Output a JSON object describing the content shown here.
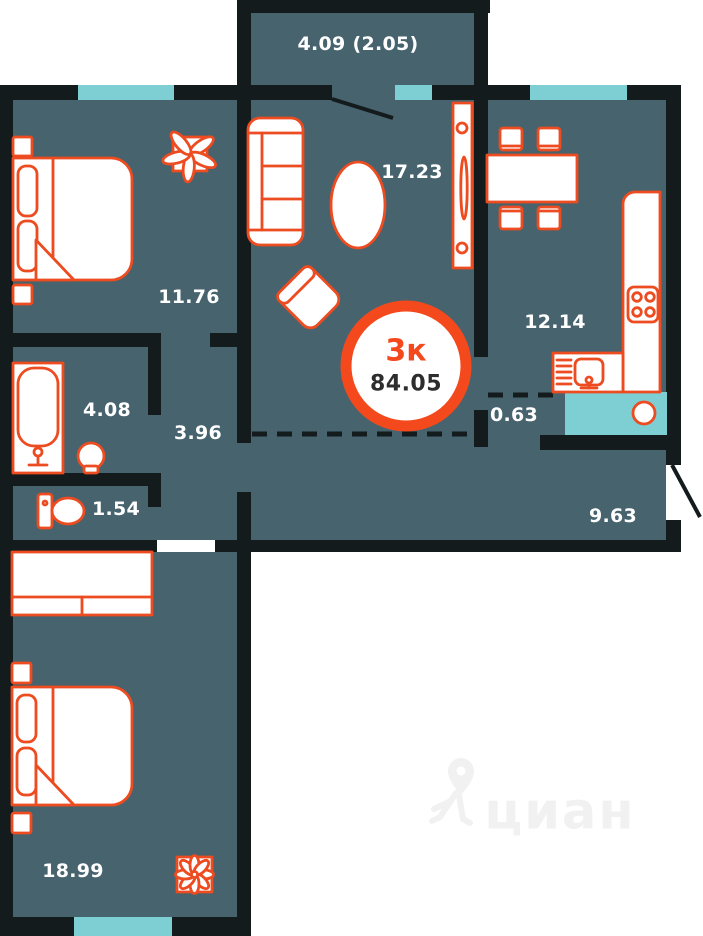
{
  "labels": {
    "balcony": "4.09 (2.05)",
    "living_room": "17.23",
    "bedroom_top": "11.76",
    "kitchen": "12.14",
    "bathroom": "4.08",
    "hallway": "3.96",
    "niche": "0.63",
    "toilet": "1.54",
    "corridor": "9.63",
    "bedroom_bottom": "18.99"
  },
  "badge": {
    "rooms": "3к",
    "area": "84.05"
  },
  "watermark": {
    "brand": "циан"
  },
  "colors": {
    "wall": "#141b1d",
    "floor": "#46636e",
    "window": "#7ecfd3",
    "furniture_outline": "#ed4b20",
    "badge_ring": "#f4491c",
    "badge_area_text": "#2d2d2d",
    "label_text": "#ffffff",
    "watermark": "#f1f1f1"
  }
}
